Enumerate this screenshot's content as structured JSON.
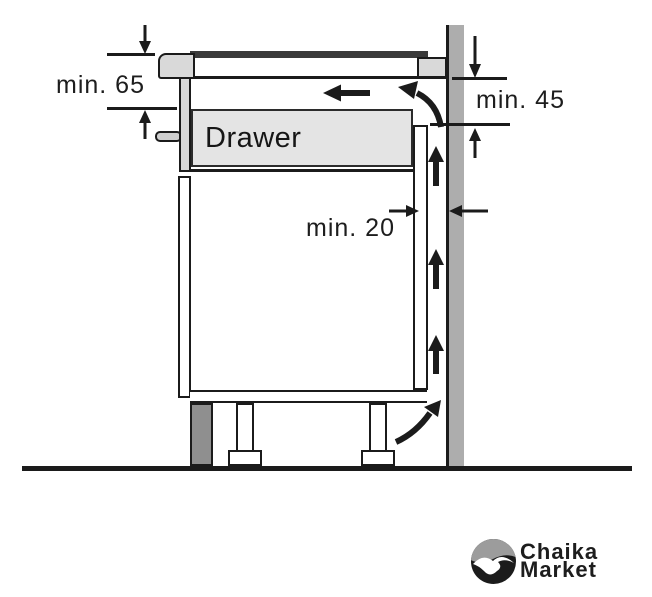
{
  "diagram": {
    "title": "hob-installation-clearance-diagram",
    "drawer_label": "Drawer",
    "dim_worktop_to_drawer": "min. 65",
    "dim_rear_vent": "min. 45",
    "dim_wall_gap": "min. 20"
  },
  "branding": {
    "logo_icon": "seagull-circle",
    "line1": "Chaika",
    "line2": "Market"
  },
  "colors": {
    "line": "#1b1b1b",
    "glass": "#3a3a3a",
    "wall": "#adadad",
    "plinth": "#8f8f8f",
    "panel": "#d9d9d9",
    "drawer": "#e4e4e4",
    "logo_gray": "#9c9c9c",
    "text": "#1d1d1d"
  }
}
